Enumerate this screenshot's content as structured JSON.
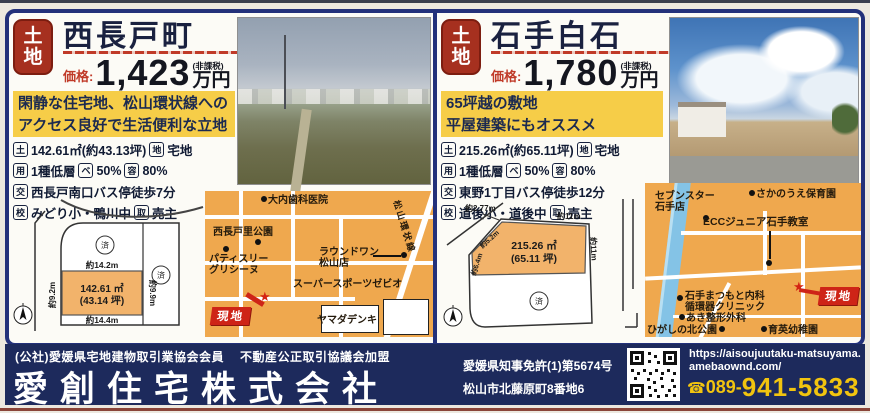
{
  "listings": [
    {
      "badge_top": "土",
      "badge_bottom": "地",
      "title": "西長戸町",
      "price_label": "価格:",
      "price_value": "1,423",
      "price_note": "(非課税)",
      "price_unit": "万円",
      "highlight1": "閑静な住宅地、松山環状線への",
      "highlight2": "アクセス良好で生活便利な立地",
      "specs": {
        "l1": {
          "b1": "土",
          "t1": "142.61㎡(約43.13坪)",
          "b2": "地",
          "t2": "宅地"
        },
        "l2": {
          "b1": "用",
          "t1": "1種低層",
          "b2": "ベ",
          "t2": "50%",
          "b3": "容",
          "t3": "80%"
        },
        "l3": {
          "b1": "交",
          "t1": "西長戸南口バス停徒歩7分"
        },
        "l4": {
          "b1": "校",
          "t1": "みどり小・鴨川中",
          "b2": "取",
          "t2": "売主"
        }
      },
      "diagram": {
        "area": "142.61 ㎡",
        "tsubo": "(43.14 坪)",
        "dim_top": "約14.2m",
        "dim_bottom": "約14.4m",
        "dim_left": "約9.2m",
        "dim_right": "約9.9m",
        "sold": "済"
      },
      "map": {
        "dental": "大内歯科医院",
        "park": "西長戸里公園",
        "patisserie1": "パティスリー",
        "patisserie2": "グリシーヌ",
        "round1a": "ラウンドワン",
        "round1b": "松山店",
        "xebio": "スーパースポーツゼビオ",
        "yamada": "ヤマダデンキ",
        "road": "松山環状線",
        "site": "現地"
      }
    },
    {
      "badge_top": "土",
      "badge_bottom": "地",
      "title": "石手白石",
      "price_label": "価格:",
      "price_value": "1,780",
      "price_note": "(非課税)",
      "price_unit": "万円",
      "highlight1": "65坪越の敷地",
      "highlight2": "平屋建築にもオススメ",
      "specs": {
        "l1": {
          "b1": "土",
          "t1": "215.26㎡(約65.11坪)",
          "b2": "地",
          "t2": "宅地"
        },
        "l2": {
          "b1": "用",
          "t1": "1種低層",
          "b2": "ベ",
          "t2": "50%",
          "b3": "容",
          "t3": "80%"
        },
        "l3": {
          "b1": "交",
          "t1": "東野1丁目バス停徒歩12分"
        },
        "l4": {
          "b1": "校",
          "t1": "道後小・道後中",
          "b2": "取",
          "t2": "売主"
        }
      },
      "diagram": {
        "area": "215.26 ㎡",
        "tsubo": "(65.11 坪)",
        "dim_top": "約2.77m",
        "dim_top2": "約11m",
        "dim_right": "約11m",
        "dim_diag1": "約5.2m",
        "dim_diag2": "約6.4m",
        "sold": "済"
      },
      "map": {
        "seven1": "セブンスター",
        "seven2": "石手店",
        "hoikuen": "さかのうえ保育園",
        "ecc": "ECCジュニア石手教室",
        "naika1": "石手まつもと内科",
        "naika2": "循環器クリニック",
        "seikei": "あき整形外科",
        "park": "ひがしの北公園",
        "youchien": "育英幼稚園",
        "site": "現地"
      }
    }
  ],
  "footer": {
    "membership": "(公社)愛媛県宅地建物取引業協会会員",
    "fair_trade": "不動産公正取引協議会加盟",
    "company": "愛創住宅株式会社",
    "license": "愛媛県知事免許(1)第5674号",
    "address": "松山市北藤原町8番地6",
    "url1": "https://aisoujuutaku-matsuyama.",
    "url2": "amebaownd.com/",
    "tel_icon": "☎",
    "tel_prefix": "089-",
    "tel_number": "941-5833",
    "accent_yellow": "#f2c40f",
    "navy": "#1d2a5c",
    "badge_red": "#a6301f"
  }
}
